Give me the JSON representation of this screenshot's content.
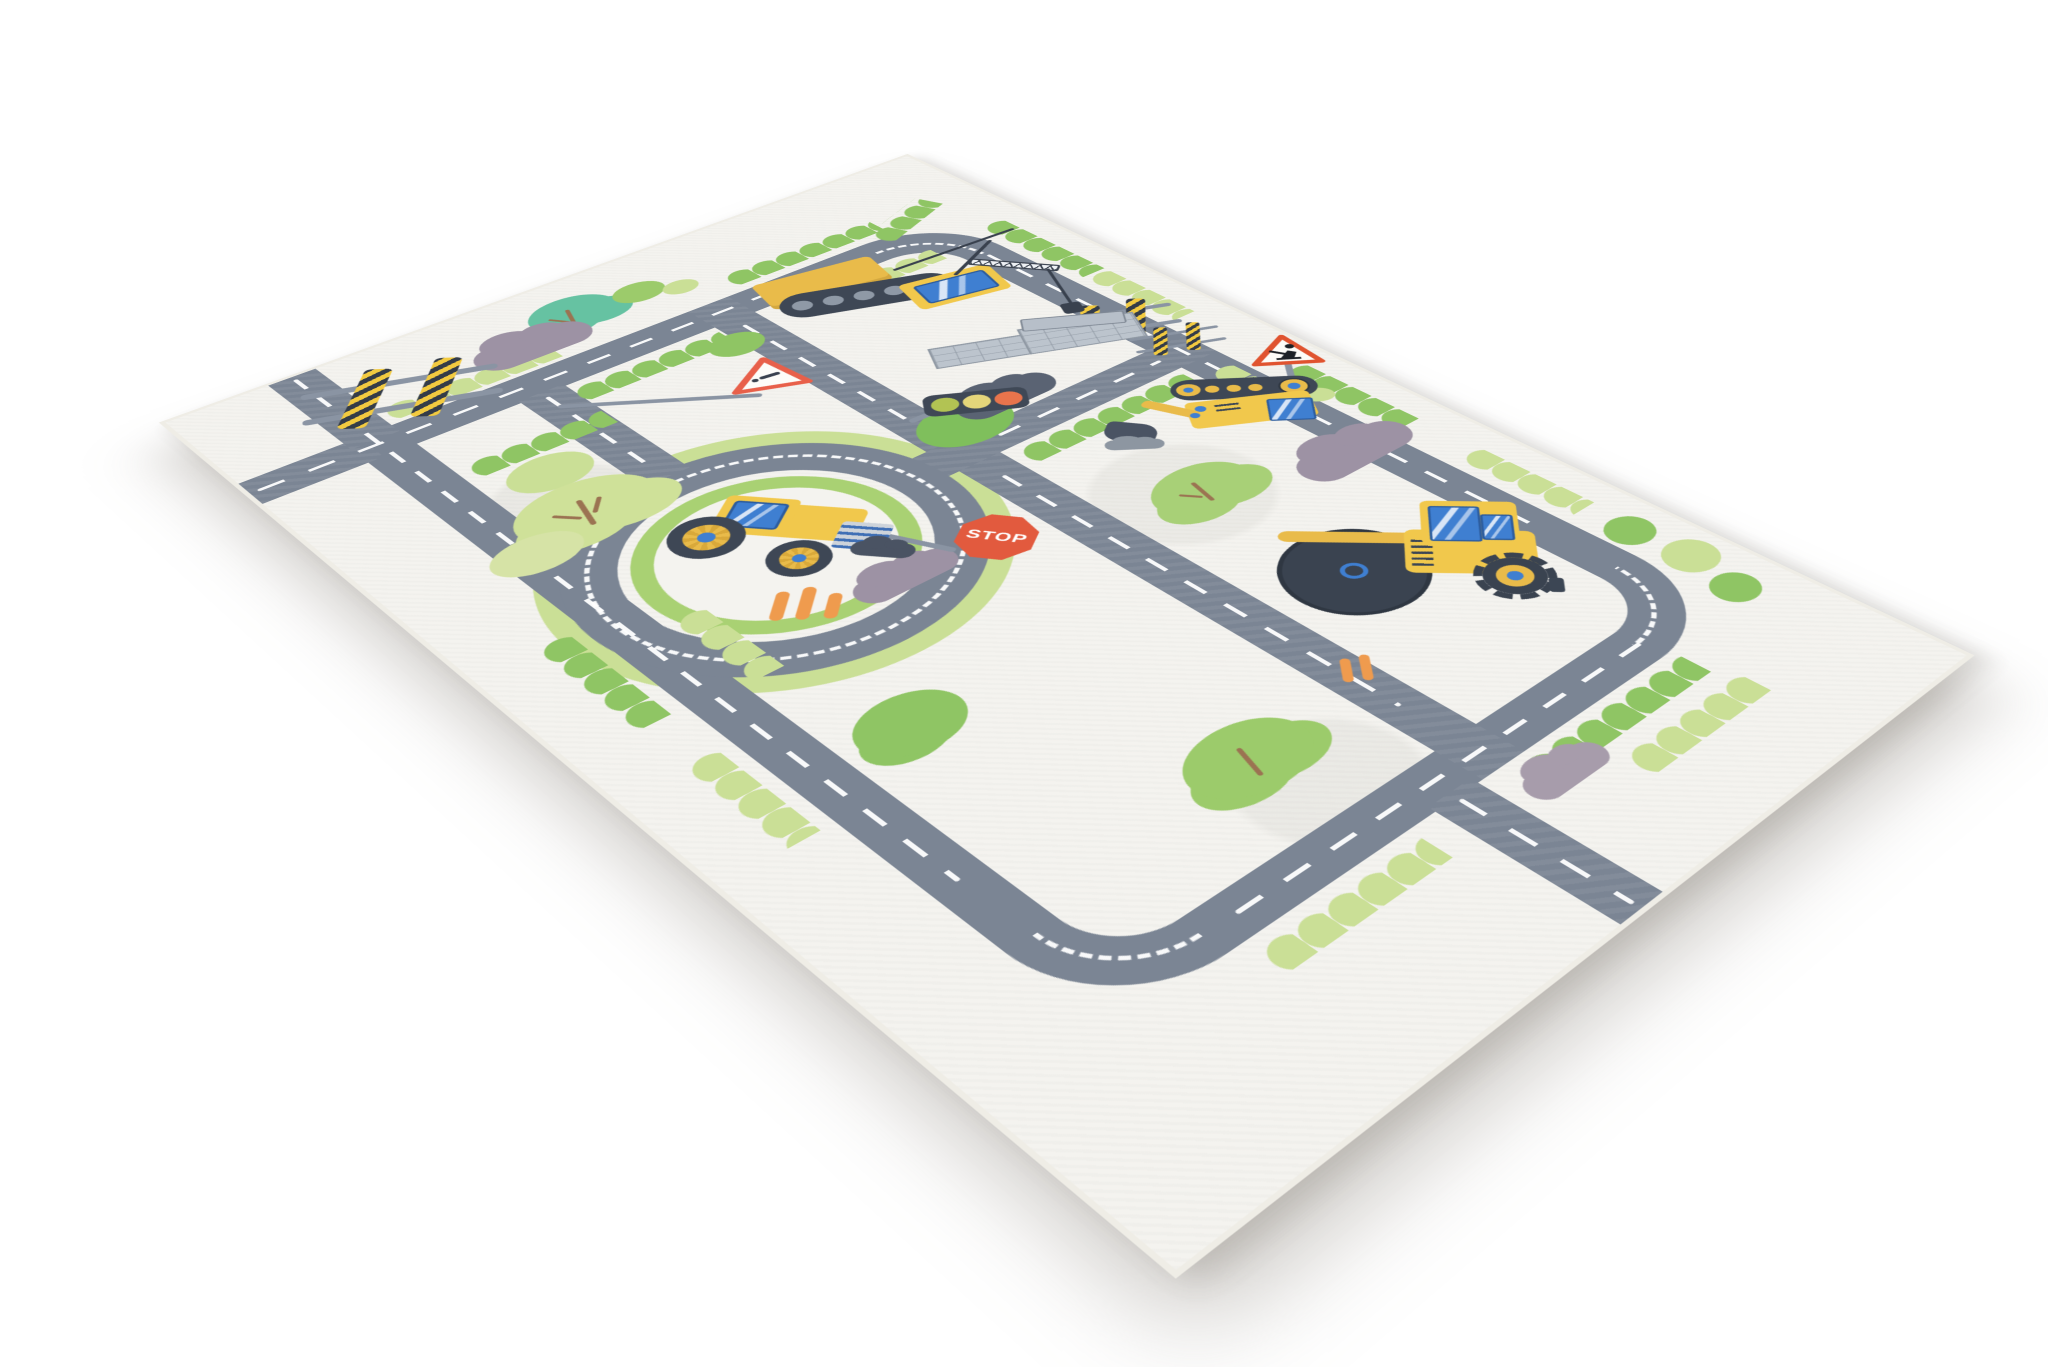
{
  "scene": {
    "type": "product photo",
    "subject": "children's road play rug with construction vehicles shown at a perspective angle",
    "background_color": "#ffffff"
  },
  "rug": {
    "base_color": "#f4f3ef",
    "edge_color": "#efede6",
    "road_color": "#7b8594",
    "lane_marking_color": "#ffffff",
    "stop_sign": {
      "text": "STOP",
      "color": "#e25a3e"
    },
    "traffic_light": {
      "housing_color": "#3f4856",
      "lights": [
        "#b2c353",
        "#e4d57a",
        "#e8744c"
      ],
      "order": [
        "green",
        "yellow",
        "red"
      ]
    },
    "signs": [
      {
        "name": "warning-sign",
        "shape": "triangle",
        "outline": "#e8604a",
        "symbol": "dash and dot"
      },
      {
        "name": "roadworks-sign",
        "shape": "triangle",
        "outline": "#e0532f",
        "symbol": "digging worker"
      },
      {
        "name": "stop-sign",
        "shape": "octagon",
        "text": "STOP"
      }
    ],
    "vehicles": [
      {
        "name": "crawler-crane",
        "description": "yellow crane on dark tracks with lattice boom, hook and concrete slab load"
      },
      {
        "name": "tractor",
        "description": "yellow tractor with blue-hub wheels and grey attachment on roundabout island"
      },
      {
        "name": "excavator",
        "description": "yellow tracked excavator with grey bucket and dirt spill"
      },
      {
        "name": "road-roller",
        "description": "yellow roller with large dark drum and spiked rear wheel"
      }
    ],
    "road_features": [
      "outer loop with rounded corners",
      "roundabout with island",
      "crossroads near left corner",
      "T junctions",
      "edge exit stubs",
      "white dashed center lines"
    ],
    "props": [
      "striped safety barriers",
      "brick pallets",
      "traffic cones",
      "dirt piles",
      "purple clouds",
      "teal tree",
      "green trees",
      "scalloped bushes"
    ],
    "green_palette": [
      "#8fc564",
      "#9ccb6b",
      "#cadf96",
      "#a9d173",
      "#66c2a2"
    ],
    "vehicle_palette": [
      "#f1c84c",
      "#3e4755",
      "#3f7fd1",
      "#b7bfc9"
    ]
  }
}
